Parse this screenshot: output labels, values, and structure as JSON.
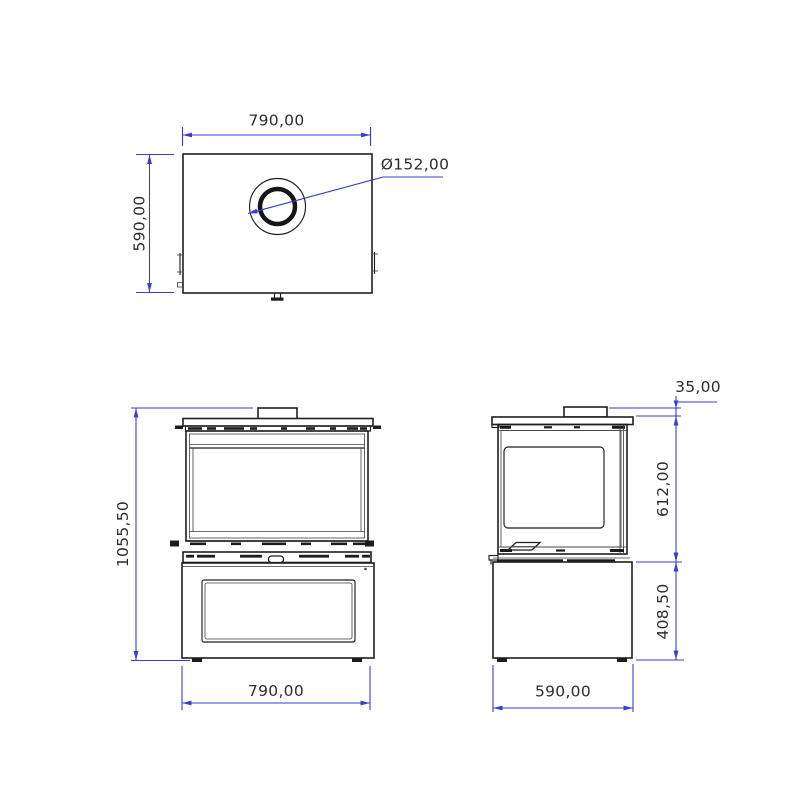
{
  "colors": {
    "dimension": "#3c3ccd",
    "line": "#1f1f1f"
  },
  "views": {
    "top": {
      "name": "top-view",
      "labels": {
        "width": "790,00",
        "depth": "590,00",
        "flue_diameter": "Ø152,00"
      }
    },
    "front": {
      "name": "front-view",
      "labels": {
        "total_height": "1055,50",
        "width": "790,00"
      }
    },
    "side": {
      "name": "side-view",
      "labels": {
        "flue_collar_height": "35,00",
        "firebox_height": "612,00",
        "base_height": "408,50",
        "depth": "590,00"
      }
    }
  }
}
